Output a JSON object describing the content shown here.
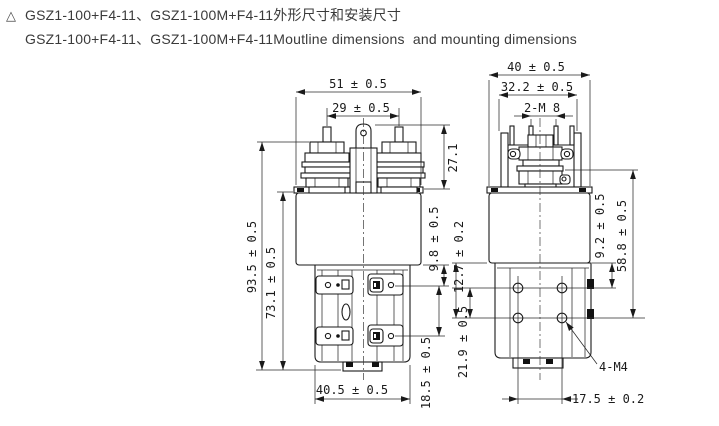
{
  "title": {
    "marker": "△",
    "line1": "GSZ1-100+F4-11、GSZ1-100M+F4-11外形尺寸和安装尺寸",
    "line2": "GSZ1-100+F4-11、GSZ1-100M+F4-11Moutline dimensions  and mounting dimensions"
  },
  "front_view": {
    "description": "contactor front outline view",
    "dims": {
      "body_width": "51 ± 0.5",
      "terminal_spacing": "29 ± 0.5",
      "terminal_height": "27.1",
      "overall_height": "93.5 ± 0.5",
      "body_height": "73.1 ± 0.5",
      "tab_row1_offset": "9.8 ± 0.5",
      "tab_row_spacing": "18.5 ± 0.5",
      "base_width": "40.5 ± 0.5"
    }
  },
  "side_view": {
    "description": "contactor side outline view with mounting holes",
    "dims": {
      "overall_width": "40 ± 0.5",
      "housing_width": "32.2 ± 0.5",
      "main_terminals": "2-M 8",
      "hole_row1_offset": "9.2 ± 0.5",
      "mounting_height": "58.8 ± 0.5",
      "hole_row_spacing": "12.7 ± 0.2",
      "hole_row2_offset": "21.9 ± 0.5",
      "hole_column_spacing": "17.5 ± 0.2",
      "mounting_holes": "4-M4"
    }
  }
}
